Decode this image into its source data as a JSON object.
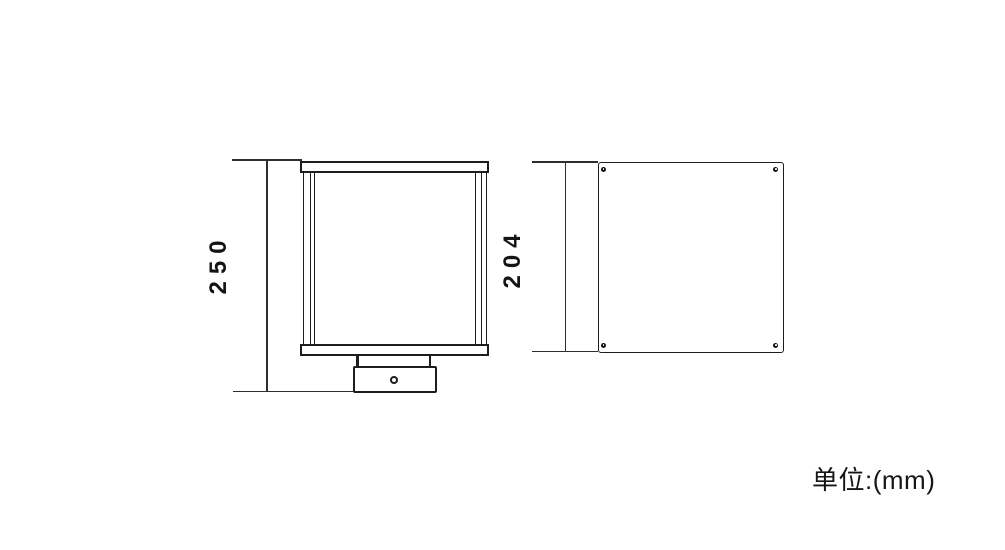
{
  "drawing": {
    "unit_note": "单位:(mm)",
    "views": {
      "front": {
        "name": "front-elevation-view",
        "dimension_label": "250"
      },
      "side": {
        "name": "rear-panel-view",
        "dimension_label": "204"
      }
    },
    "colors": {
      "line": "#1d1d1b",
      "dimension_line": "#2e2e2e",
      "background": "#ffffff"
    }
  }
}
